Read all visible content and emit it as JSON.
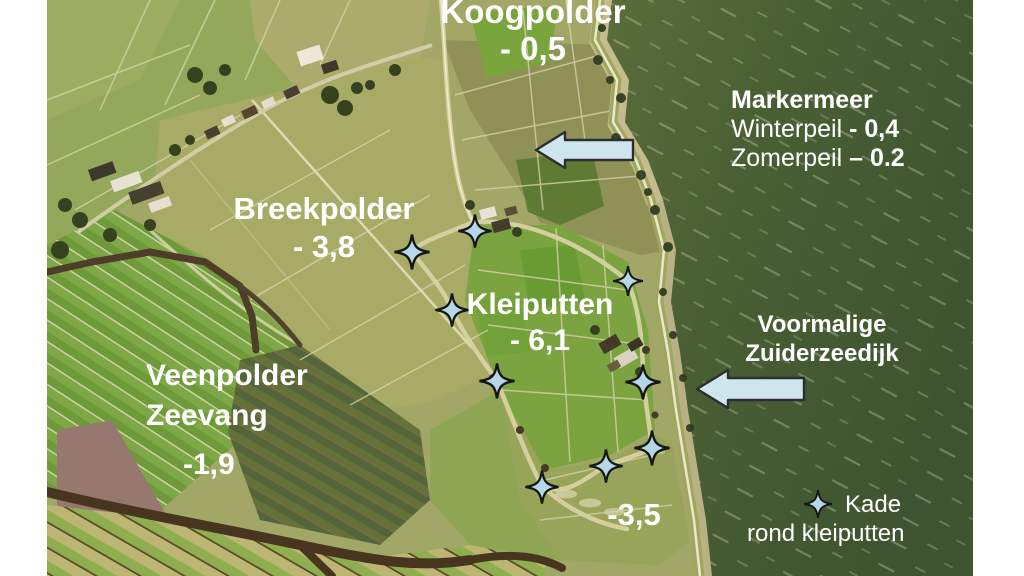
{
  "slide": {
    "description_labels": {
      "koogpolder": {
        "name": "Koogpolder",
        "value": "- 0,5"
      },
      "markermeer": {
        "title": "Markermeer",
        "winter_label": "Winterpeil",
        "winter_value": "- 0,4",
        "summer_label": "Zomerpeil",
        "summer_value": "– 0.2"
      },
      "breekpolder": {
        "name": "Breekpolder",
        "value": "- 3,8"
      },
      "kleiputten": {
        "name": "Kleiputten",
        "value": "- 6,1"
      },
      "veenpolder": {
        "name_line1": "Veenpolder",
        "name_line2": "Zeevang",
        "value": "-1,9"
      },
      "zuiderzeedijk": {
        "line1": "Voormalige",
        "line2": "Zuiderzeedijk"
      },
      "south_area_value": "-3,5",
      "legend": {
        "line1": "Kade",
        "line2": "rond kleiputten"
      }
    },
    "annotations": {
      "star_fill": "#b5d7e8",
      "star_outline": "#161616",
      "arrow_fill": "#cfe5ee",
      "arrow_outline": "#2d2d2d",
      "stars": [
        {
          "x": 475,
          "y": 231,
          "size": 38
        },
        {
          "x": 412,
          "y": 252,
          "size": 40
        },
        {
          "x": 452,
          "y": 310,
          "size": 38
        },
        {
          "x": 497,
          "y": 381,
          "size": 40
        },
        {
          "x": 542,
          "y": 487,
          "size": 38
        },
        {
          "x": 606,
          "y": 466,
          "size": 38
        },
        {
          "x": 652,
          "y": 448,
          "size": 40
        },
        {
          "x": 643,
          "y": 382,
          "size": 40
        },
        {
          "x": 628,
          "y": 281,
          "size": 34
        }
      ],
      "legend_star": {
        "x": 818,
        "y": 504,
        "size": 32
      },
      "arrows": [
        {
          "tip_x": 535,
          "tip_y": 150,
          "length": 100,
          "thickness": 20,
          "head_len": 30,
          "head_w": 38
        },
        {
          "tip_x": 696,
          "tip_y": 389,
          "length": 110,
          "thickness": 22,
          "head_len": 32,
          "head_w": 40
        }
      ]
    }
  }
}
